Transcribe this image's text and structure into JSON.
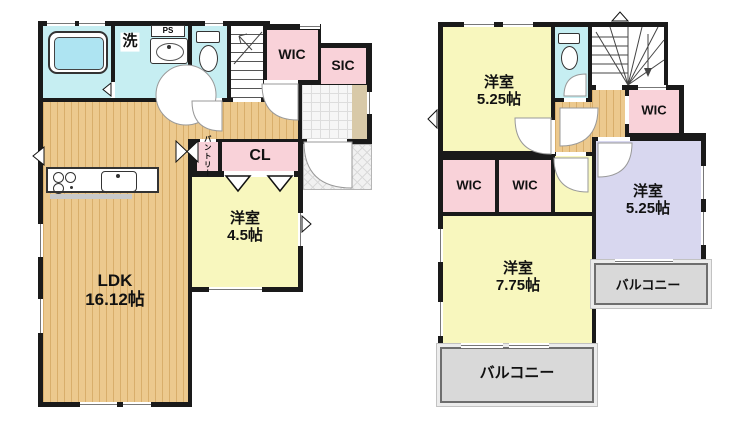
{
  "plan_type": "floorplan",
  "colors": {
    "wall": "#1a1a1a",
    "wood_floor": "#ecc98e",
    "room_yellow": "#f8f7be",
    "wet_area_cyan": "#c6eef2",
    "closet_pink": "#f9d2d9",
    "room_lavender": "#d8d7ef",
    "balcony_gray": "#d9d9d9"
  },
  "floor1": {
    "laundry": "洗",
    "ps": "PS",
    "wic": "WIC",
    "sic": "SIC",
    "pantry": "パントリー",
    "closet": "CL",
    "bedroom": {
      "name": "洋室",
      "size": "4.5帖"
    },
    "ldk": {
      "name": "LDK",
      "size": "16.12帖"
    }
  },
  "floor2": {
    "bedroom_nw": {
      "name": "洋室",
      "size": "5.25帖"
    },
    "wic_a": "WIC",
    "wic_b": "WIC",
    "wic_east": "WIC",
    "bedroom_south": {
      "name": "洋室",
      "size": "7.75帖"
    },
    "bedroom_east": {
      "name": "洋室",
      "size": "5.25帖"
    },
    "balcony_south": "バルコニー",
    "balcony_east": "バルコニー"
  }
}
